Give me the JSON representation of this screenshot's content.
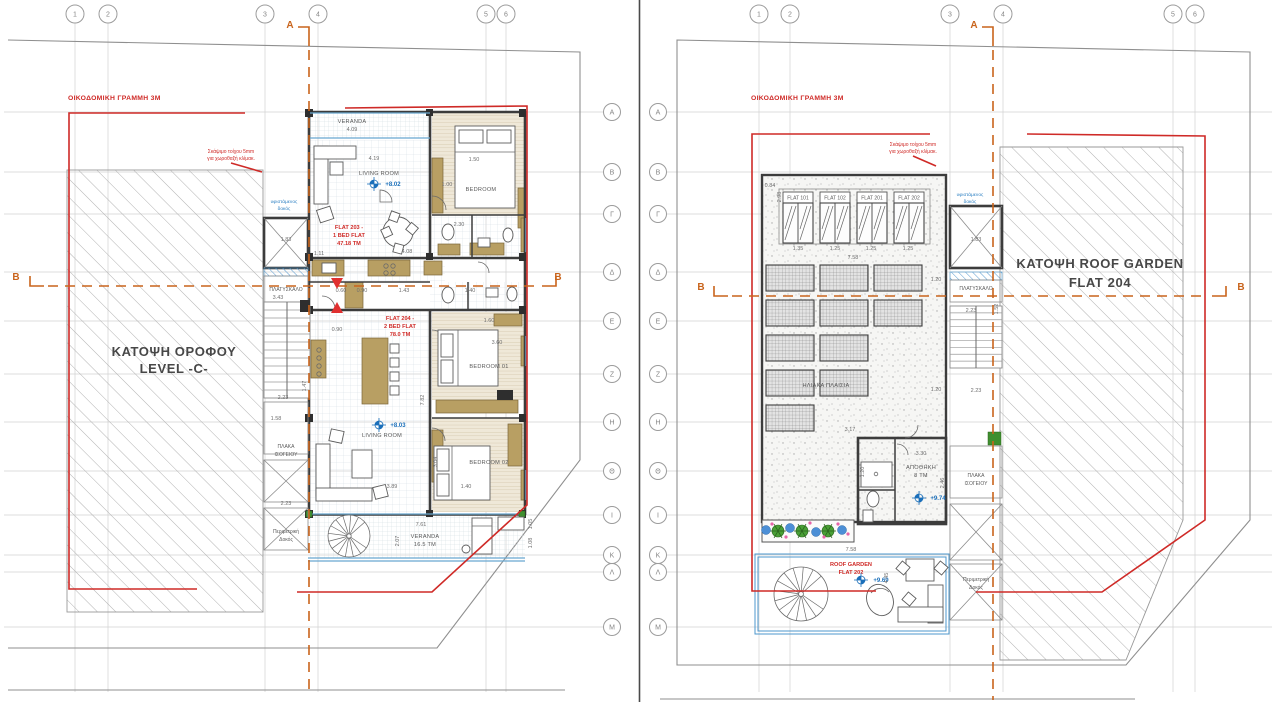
{
  "titles": {
    "left_line1": "ΚΑΤΟΨΗ ΟΡΟΦΟΥ",
    "left_line2": "LEVEL -C-",
    "right_line1": "ΚΑΤΟΨΗ ROOF GARDEN",
    "right_line2": "FLAT 204"
  },
  "section_labels": {
    "a": "A",
    "b": "B"
  },
  "building_line_label": "ΟΙΚΟΔΟΜΙΚΗ ΓΡΑΜΜΗ 3Μ",
  "excavation_note": {
    "line1": "Σκάψιμο τοίχου 5mm",
    "line2": "για χωροθαξή κλίμακ."
  },
  "colors": {
    "regulation_red": "#cf2a27",
    "section_orange": "#c9641c",
    "level_blue": "#1a6fba",
    "glazing_blue": "#69a8d0",
    "furniture_tan": "#b89f63",
    "wall_dark": "#3c3c3c"
  },
  "grid": {
    "cols": [
      "1",
      "2",
      "3",
      "4",
      "5",
      "6"
    ],
    "col_x_left": [
      75,
      108,
      265,
      318,
      486,
      506
    ],
    "col_x_right": [
      759,
      790,
      950,
      1003,
      1173,
      1195
    ],
    "rows": [
      "A",
      "B",
      "Γ",
      "Δ",
      "E",
      "Z",
      "H",
      "Θ",
      "I",
      "K",
      "Λ",
      "M"
    ],
    "row_y": [
      112,
      172,
      214,
      272,
      321,
      374,
      422,
      471,
      515,
      555,
      572,
      627
    ],
    "row_bubble_x_left": 612,
    "row_bubble_x_right": 658
  },
  "skylights": {
    "labels": [
      "FLAT 101",
      "FLAT 102",
      "FLAT 201",
      "FLAT 202"
    ],
    "x": [
      783,
      820,
      857,
      894
    ],
    "label_y": 192,
    "glass_y": 203,
    "w": 30,
    "label_h": 11,
    "glass_h": 40
  },
  "solar_panels": {
    "w": 48,
    "h": 26,
    "pos": [
      [
        766,
        265
      ],
      [
        820,
        265
      ],
      [
        874,
        265
      ],
      [
        766,
        300
      ],
      [
        820,
        300
      ],
      [
        874,
        300
      ],
      [
        766,
        335
      ],
      [
        820,
        335
      ],
      [
        766,
        370
      ],
      [
        820,
        370
      ],
      [
        766,
        405
      ]
    ]
  },
  "level_markers": [
    {
      "x": 374,
      "y": 184
    },
    {
      "x": 379,
      "y": 425
    },
    {
      "x": 919,
      "y": 498
    },
    {
      "x": 861,
      "y": 580
    }
  ],
  "annotations_left": [
    {
      "t": "VERANDA",
      "x": 352,
      "y": 123,
      "c": "room"
    },
    {
      "t": "4.09",
      "x": 352,
      "y": 131,
      "c": "dim"
    },
    {
      "t": "4.19",
      "x": 374,
      "y": 160,
      "c": "dim"
    },
    {
      "t": "LIVING ROOM",
      "x": 379,
      "y": 175,
      "c": "room"
    },
    {
      "t": "+8.02",
      "x": 393,
      "y": 186,
      "c": "lvl"
    },
    {
      "t": "BEDROOM",
      "x": 481,
      "y": 191,
      "c": "room"
    },
    {
      "t": "1.50",
      "x": 474,
      "y": 161,
      "c": "dim"
    },
    {
      "t": "1.00",
      "x": 447,
      "y": 186,
      "c": "dim"
    },
    {
      "t": "FLAT 203 -",
      "x": 349,
      "y": 229,
      "c": "red"
    },
    {
      "t": "1 BED FLAT",
      "x": 349,
      "y": 237,
      "c": "red"
    },
    {
      "t": "47.18 ΤΜ",
      "x": 349,
      "y": 245,
      "c": "red"
    },
    {
      "t": "2.30",
      "x": 459,
      "y": 226,
      "c": "dim"
    },
    {
      "t": "4.08",
      "x": 407,
      "y": 253,
      "c": "dim"
    },
    {
      "t": "1.11",
      "x": 319,
      "y": 255,
      "c": "dim"
    },
    {
      "t": "0.60",
      "x": 341,
      "y": 292,
      "c": "dim"
    },
    {
      "t": "0.90",
      "x": 362,
      "y": 292,
      "c": "dim"
    },
    {
      "t": "1.43",
      "x": 404,
      "y": 292,
      "c": "dim"
    },
    {
      "t": "1.40",
      "x": 470,
      "y": 292,
      "c": "dim"
    },
    {
      "t": "FLAT 204 -",
      "x": 400,
      "y": 320,
      "c": "red"
    },
    {
      "t": "2 BED FLAT",
      "x": 400,
      "y": 328,
      "c": "red"
    },
    {
      "t": "78.0 ΤΜ",
      "x": 400,
      "y": 336,
      "c": "red"
    },
    {
      "t": "0.90",
      "x": 337,
      "y": 331,
      "c": "dim"
    },
    {
      "t": "3.60",
      "x": 497,
      "y": 344,
      "c": "dim"
    },
    {
      "t": "1.60",
      "x": 489,
      "y": 322,
      "c": "dim"
    },
    {
      "t": "BEDROOM 01",
      "x": 489,
      "y": 368,
      "c": "room"
    },
    {
      "t": "7.82",
      "x": 424,
      "y": 400,
      "c": "dim",
      "r": -90
    },
    {
      "t": "3.04",
      "x": 437,
      "y": 462,
      "c": "dim",
      "r": -90
    },
    {
      "t": "+8.03",
      "x": 398,
      "y": 427,
      "c": "lvl"
    },
    {
      "t": "LIVING ROOM",
      "x": 382,
      "y": 437,
      "c": "room"
    },
    {
      "t": "BEDROOM 02",
      "x": 489,
      "y": 464,
      "c": "room"
    },
    {
      "t": "3.89",
      "x": 392,
      "y": 488,
      "c": "dim"
    },
    {
      "t": "1.40",
      "x": 466,
      "y": 488,
      "c": "dim"
    },
    {
      "t": "7.61",
      "x": 421,
      "y": 526,
      "c": "dim"
    },
    {
      "t": "VERANDA",
      "x": 425,
      "y": 538,
      "c": "room"
    },
    {
      "t": "16.5 ΤΜ",
      "x": 425,
      "y": 546,
      "c": "room"
    },
    {
      "t": "2.07",
      "x": 399,
      "y": 541,
      "c": "dim",
      "r": -90
    },
    {
      "t": "1.05",
      "x": 532,
      "y": 524,
      "c": "dim",
      "r": -90
    },
    {
      "t": "1.08",
      "x": 532,
      "y": 543,
      "c": "dim",
      "r": -90
    },
    {
      "t": "ΠΛΑΤΥΣΚΑΛΟ",
      "x": 286,
      "y": 291,
      "c": "core"
    },
    {
      "t": "3.43",
      "x": 278,
      "y": 299,
      "c": "dim"
    },
    {
      "t": "1.83",
      "x": 286,
      "y": 241,
      "c": "dim"
    },
    {
      "t": "υφιστάμενος",
      "x": 284,
      "y": 203,
      "c": "blue"
    },
    {
      "t": "δοκός",
      "x": 284,
      "y": 210,
      "c": "blue"
    },
    {
      "t": "2.23",
      "x": 283,
      "y": 399,
      "c": "dim"
    },
    {
      "t": "1.47",
      "x": 306,
      "y": 386,
      "c": "dim",
      "r": -90
    },
    {
      "t": "1.58",
      "x": 276,
      "y": 420,
      "c": "dim"
    },
    {
      "t": "ΠΛΑΚΑ",
      "x": 286,
      "y": 448,
      "c": "core"
    },
    {
      "t": "ΙΣΟΓΕΙΟΥ",
      "x": 286,
      "y": 456,
      "c": "core"
    },
    {
      "t": "2.23",
      "x": 286,
      "y": 505,
      "c": "dim"
    },
    {
      "t": "Περιμετρική",
      "x": 286,
      "y": 533,
      "c": "core"
    },
    {
      "t": "Δοκός",
      "x": 286,
      "y": 541,
      "c": "core"
    }
  ],
  "annotations_right": [
    {
      "t": "0.84",
      "x": 770,
      "y": 187,
      "c": "dim"
    },
    {
      "t": "2.98",
      "x": 781,
      "y": 197,
      "c": "dim",
      "r": -90
    },
    {
      "t": "1.35",
      "x": 798,
      "y": 250,
      "c": "dim"
    },
    {
      "t": "1.25",
      "x": 835,
      "y": 250,
      "c": "dim"
    },
    {
      "t": "1.25",
      "x": 871,
      "y": 250,
      "c": "dim"
    },
    {
      "t": "1.25",
      "x": 908,
      "y": 250,
      "c": "dim"
    },
    {
      "t": "7.58",
      "x": 853,
      "y": 259,
      "c": "dim"
    },
    {
      "t": "1.20",
      "x": 936,
      "y": 281,
      "c": "dim"
    },
    {
      "t": "1.20",
      "x": 936,
      "y": 391,
      "c": "dim"
    },
    {
      "t": "ΗΛΙΑΚΑ ΠΛΑΙΣΙΑ",
      "x": 826,
      "y": 387,
      "c": "room"
    },
    {
      "t": "3.17",
      "x": 850,
      "y": 431,
      "c": "dim"
    },
    {
      "t": "ΑΠΟΘΗΚΗ",
      "x": 921,
      "y": 469,
      "c": "room"
    },
    {
      "t": "8 ΤΜ",
      "x": 921,
      "y": 477,
      "c": "room"
    },
    {
      "t": "3.30",
      "x": 921,
      "y": 455,
      "c": "dim"
    },
    {
      "t": "+9.74",
      "x": 938,
      "y": 500,
      "c": "lvl"
    },
    {
      "t": "2.46",
      "x": 944,
      "y": 483,
      "c": "dim",
      "r": -90
    },
    {
      "t": "1.20",
      "x": 864,
      "y": 472,
      "c": "dim",
      "r": -90
    },
    {
      "t": "υφιστάμενος",
      "x": 970,
      "y": 196,
      "c": "blue"
    },
    {
      "t": "δοκός",
      "x": 970,
      "y": 203,
      "c": "blue"
    },
    {
      "t": "1.83",
      "x": 976,
      "y": 241,
      "c": "dim"
    },
    {
      "t": "ΠΛΑΤΥΣΚΑΛΟ",
      "x": 976,
      "y": 290,
      "c": "core"
    },
    {
      "t": "2.23",
      "x": 971,
      "y": 312,
      "c": "dim"
    },
    {
      "t": "1.52",
      "x": 998,
      "y": 309,
      "c": "dim",
      "r": -90
    },
    {
      "t": "2.23",
      "x": 976,
      "y": 392,
      "c": "dim"
    },
    {
      "t": "ΠΛΑΚΑ",
      "x": 976,
      "y": 477,
      "c": "core"
    },
    {
      "t": "ΙΣΟΓΕΙΟΥ",
      "x": 976,
      "y": 485,
      "c": "core"
    },
    {
      "t": "Περιμετρική",
      "x": 976,
      "y": 581,
      "c": "core"
    },
    {
      "t": "Δοκός",
      "x": 976,
      "y": 589,
      "c": "core"
    },
    {
      "t": "7.58",
      "x": 851,
      "y": 551,
      "c": "dim"
    },
    {
      "t": "ROOF GARDEN",
      "x": 851,
      "y": 566,
      "c": "red"
    },
    {
      "t": "FLAT 202",
      "x": 851,
      "y": 574,
      "c": "red"
    },
    {
      "t": "+9.69",
      "x": 881,
      "y": 582,
      "c": "lvl"
    },
    {
      "t": "4.45",
      "x": 888,
      "y": 578,
      "c": "dim",
      "r": -90
    }
  ]
}
